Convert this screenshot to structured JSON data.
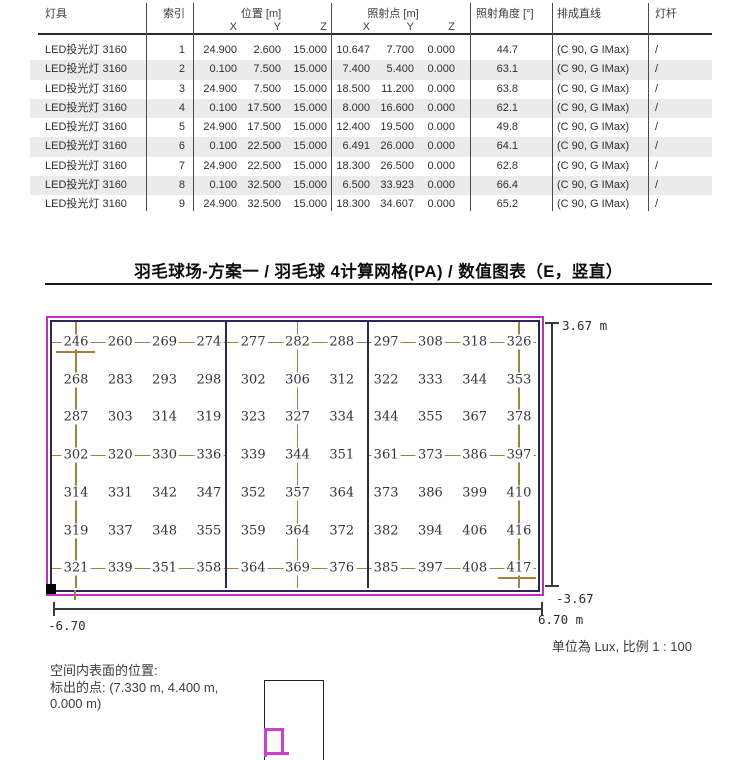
{
  "header_table": {
    "columns": {
      "luminaire": "灯具",
      "index": "索引",
      "position": "位置 [m]",
      "aiming": "照射点 [m]",
      "angle": "照射角度 [°]",
      "line": "排成直线",
      "pole": "灯杆",
      "sub_x": "X",
      "sub_y": "Y",
      "sub_z": "Z"
    },
    "rows": [
      {
        "luminaire": "LED投光灯 3160",
        "index": "1",
        "px": "24.900",
        "py": "2.600",
        "pz": "15.000",
        "ax": "10.647",
        "ay": "7.700",
        "az": "0.000",
        "angle": "44.7",
        "line": "(C 90, G IMax)",
        "pole": "/"
      },
      {
        "luminaire": "LED投光灯 3160",
        "index": "2",
        "px": "0.100",
        "py": "7.500",
        "pz": "15.000",
        "ax": "7.400",
        "ay": "5.400",
        "az": "0.000",
        "angle": "63.1",
        "line": "(C 90, G IMax)",
        "pole": "/"
      },
      {
        "luminaire": "LED投光灯 3160",
        "index": "3",
        "px": "24.900",
        "py": "7.500",
        "pz": "15.000",
        "ax": "18.500",
        "ay": "11.200",
        "az": "0.000",
        "angle": "63.8",
        "line": "(C 90, G IMax)",
        "pole": "/"
      },
      {
        "luminaire": "LED投光灯 3160",
        "index": "4",
        "px": "0.100",
        "py": "17.500",
        "pz": "15.000",
        "ax": "8.000",
        "ay": "16.600",
        "az": "0.000",
        "angle": "62.1",
        "line": "(C 90, G IMax)",
        "pole": "/"
      },
      {
        "luminaire": "LED投光灯 3160",
        "index": "5",
        "px": "24.900",
        "py": "17.500",
        "pz": "15.000",
        "ax": "12.400",
        "ay": "19.500",
        "az": "0.000",
        "angle": "49.8",
        "line": "(C 90, G IMax)",
        "pole": "/"
      },
      {
        "luminaire": "LED投光灯 3160",
        "index": "6",
        "px": "0.100",
        "py": "22.500",
        "pz": "15.000",
        "ax": "6.491",
        "ay": "26.000",
        "az": "0.000",
        "angle": "64.1",
        "line": "(C 90, G IMax)",
        "pole": "/"
      },
      {
        "luminaire": "LED投光灯 3160",
        "index": "7",
        "px": "24.900",
        "py": "22.500",
        "pz": "15.000",
        "ax": "18.300",
        "ay": "26.500",
        "az": "0.000",
        "angle": "62.8",
        "line": "(C 90, G IMax)",
        "pole": "/"
      },
      {
        "luminaire": "LED投光灯 3160",
        "index": "8",
        "px": "0.100",
        "py": "32.500",
        "pz": "15.000",
        "ax": "6.500",
        "ay": "33.923",
        "az": "0.000",
        "angle": "66.4",
        "line": "(C 90, G IMax)",
        "pole": "/"
      },
      {
        "luminaire": "LED投光灯 3160",
        "index": "9",
        "px": "24.900",
        "py": "32.500",
        "pz": "15.000",
        "ax": "18.300",
        "ay": "34.607",
        "az": "0.000",
        "angle": "65.2",
        "line": "(C 90, G IMax)",
        "pole": "/"
      }
    ]
  },
  "section_title": "羽毛球场-方案一 / 羽毛球 4计算网格(PA) / 数值图表（E，竖直）",
  "chart_data": {
    "type": "heatmap",
    "title": "羽毛球场-方案一 / 羽毛球 4计算网格(PA) / 数值图表（E，竖直）",
    "unit": "Lux",
    "scale": "1 : 100",
    "x_range_m": [
      -6.7,
      6.7
    ],
    "y_range_m": [
      -3.67,
      3.67
    ],
    "rows": 7,
    "cols": 11,
    "values": [
      [
        246,
        260,
        269,
        274,
        277,
        282,
        288,
        297,
        308,
        318,
        326
      ],
      [
        268,
        283,
        293,
        298,
        302,
        306,
        312,
        322,
        333,
        344,
        353
      ],
      [
        287,
        303,
        314,
        319,
        323,
        327,
        334,
        344,
        355,
        367,
        378
      ],
      [
        302,
        320,
        330,
        336,
        339,
        344,
        351,
        361,
        373,
        386,
        397
      ],
      [
        314,
        331,
        342,
        347,
        352,
        357,
        364,
        373,
        386,
        399,
        410
      ],
      [
        319,
        337,
        348,
        355,
        359,
        364,
        372,
        382,
        394,
        406,
        416
      ],
      [
        321,
        339,
        351,
        358,
        364,
        369,
        376,
        385,
        397,
        408,
        417
      ]
    ],
    "dims": {
      "top_right": "3.67 m",
      "bottom_right_v": "-3.67",
      "left": "-6.70",
      "right": "6.70 m"
    }
  },
  "scale_note": "单位為 Lux, 比例 1 : 100",
  "surface_location": {
    "line1": "空间内表面的位置:",
    "line2": "标出的点: (7.330 m, 4.400 m,",
    "line3": "0.000 m)"
  }
}
